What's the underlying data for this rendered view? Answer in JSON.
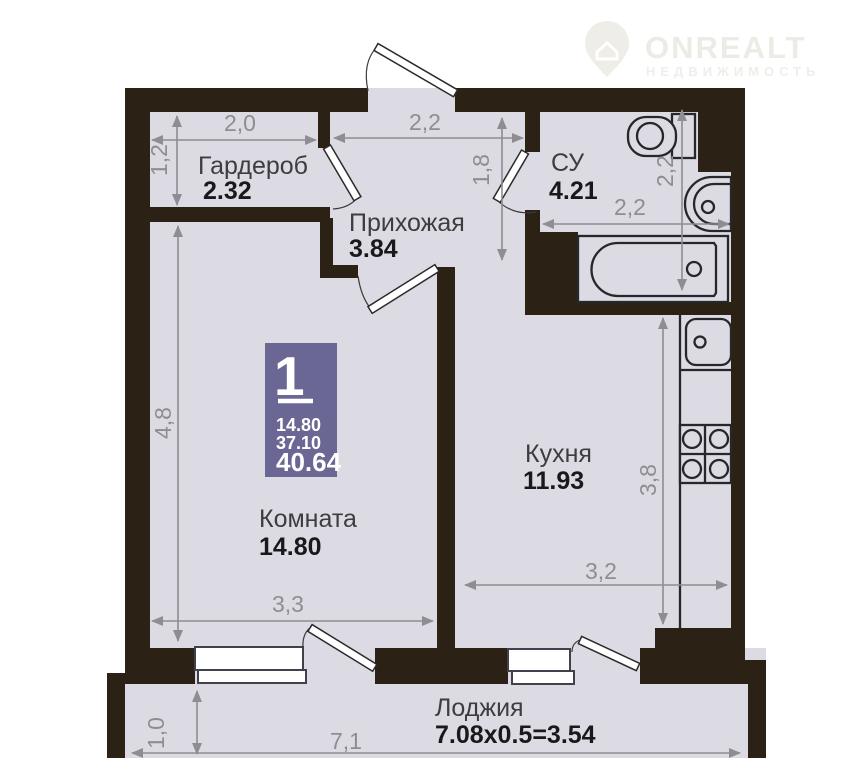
{
  "watermark": {
    "brand": "ONREALT",
    "subtitle": "НЕДВИЖИМОСТЬ"
  },
  "info_badge": {
    "room_count": "1",
    "room_area": "14.80",
    "living_area": "37.10",
    "total_area": "40.64"
  },
  "rooms": {
    "wardrobe": {
      "name": "Гардероб",
      "area": "2.32",
      "width_label": "2,0",
      "height_label": "1,2"
    },
    "hallway": {
      "name": "Прихожая",
      "area": "3.84",
      "width_label": "2,2",
      "height_label": "1,8"
    },
    "bathroom": {
      "name": "СУ",
      "area": "4.21",
      "width_label": "2,2",
      "height_label": "2,2"
    },
    "kitchen": {
      "name": "Кухня",
      "area": "11.93",
      "width_label": "3,2",
      "height_label": "3,8"
    },
    "living_room": {
      "name": "Комната",
      "area": "14.80",
      "width_label": "3,3",
      "height_label": "4,8"
    },
    "loggia": {
      "name": "Лоджия",
      "area": "7.08x0.5=3.54",
      "width_label": "7,1",
      "height_label": "1,0"
    }
  },
  "colors": {
    "wall": "#2b2115",
    "floor": "#dcdbe3",
    "dimension": "#8d8d92",
    "badge": "#6a6794",
    "room_label": "#3d3d40",
    "area_label": "#19191b",
    "watermark": "#edebe5"
  }
}
